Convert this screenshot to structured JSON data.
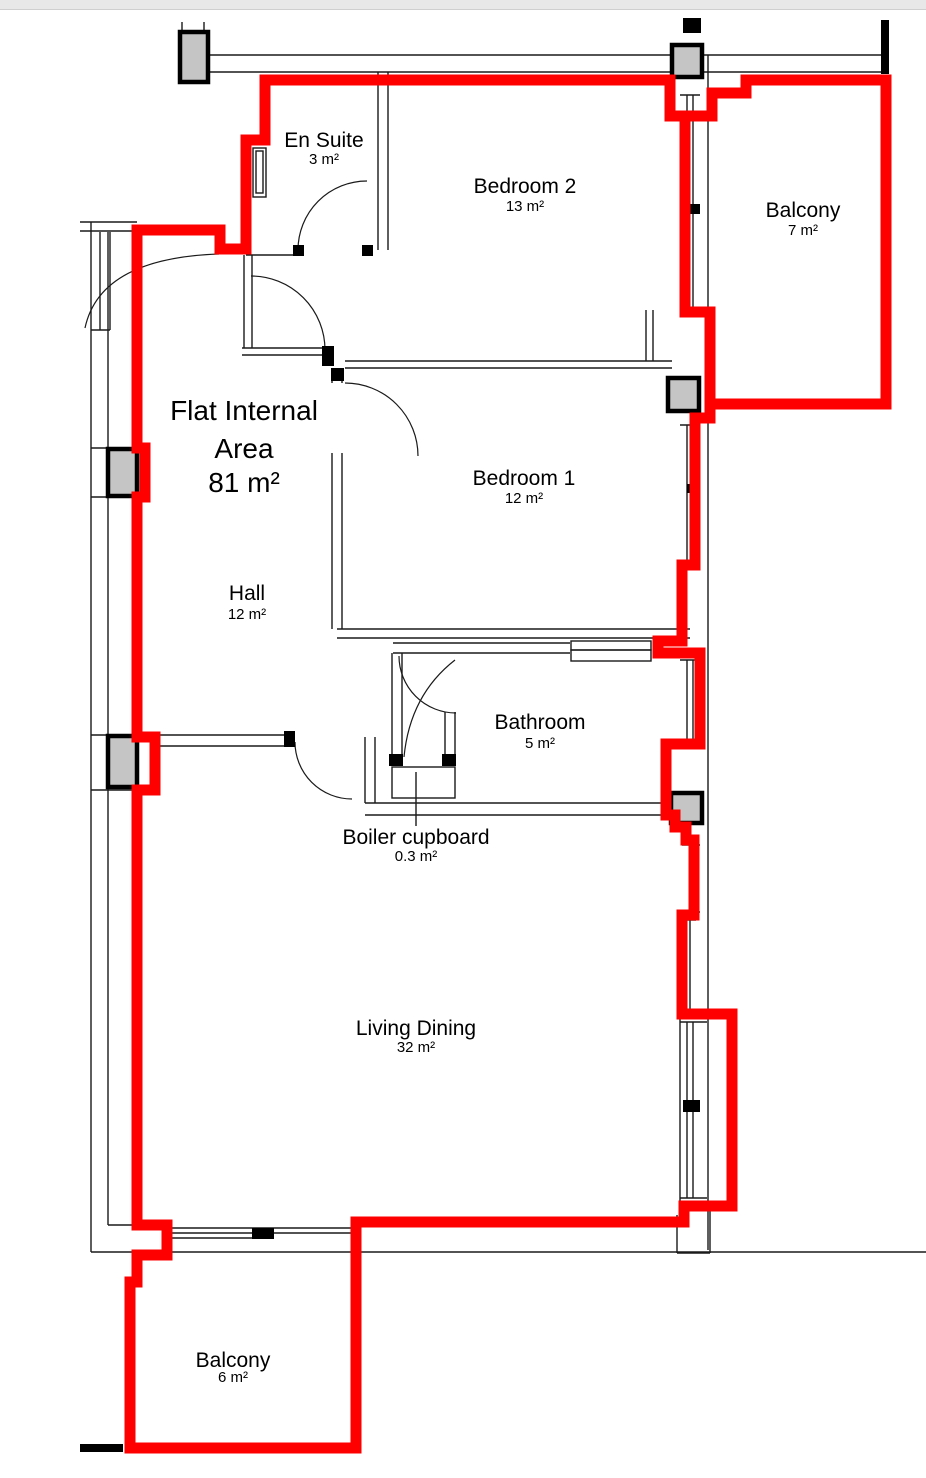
{
  "colors": {
    "boundary_red": "#ff0000",
    "wall_black": "#1a1a1a",
    "column_gray": "#c5c5c5",
    "topbar_gray": "#e8e8e8"
  },
  "plan": {
    "title": {
      "line1": "Flat Internal",
      "line2": "Area",
      "area": "81 m²"
    },
    "rooms": [
      {
        "id": "en-suite",
        "name": "En Suite",
        "area": "3 m²"
      },
      {
        "id": "bedroom-2",
        "name": "Bedroom 2",
        "area": "13 m²"
      },
      {
        "id": "balcony-top",
        "name": "Balcony",
        "area": "7 m²"
      },
      {
        "id": "bedroom-1",
        "name": "Bedroom 1",
        "area": "12 m²"
      },
      {
        "id": "hall",
        "name": "Hall",
        "area": "12 m²"
      },
      {
        "id": "bathroom",
        "name": "Bathroom",
        "area": "5 m²"
      },
      {
        "id": "boiler-cupboard",
        "name": "Boiler cupboard",
        "area": "0.3 m²"
      },
      {
        "id": "living-dining",
        "name": "Living Dining",
        "area": "32 m²"
      },
      {
        "id": "balcony-bottom",
        "name": "Balcony",
        "area": "6 m²"
      }
    ]
  }
}
